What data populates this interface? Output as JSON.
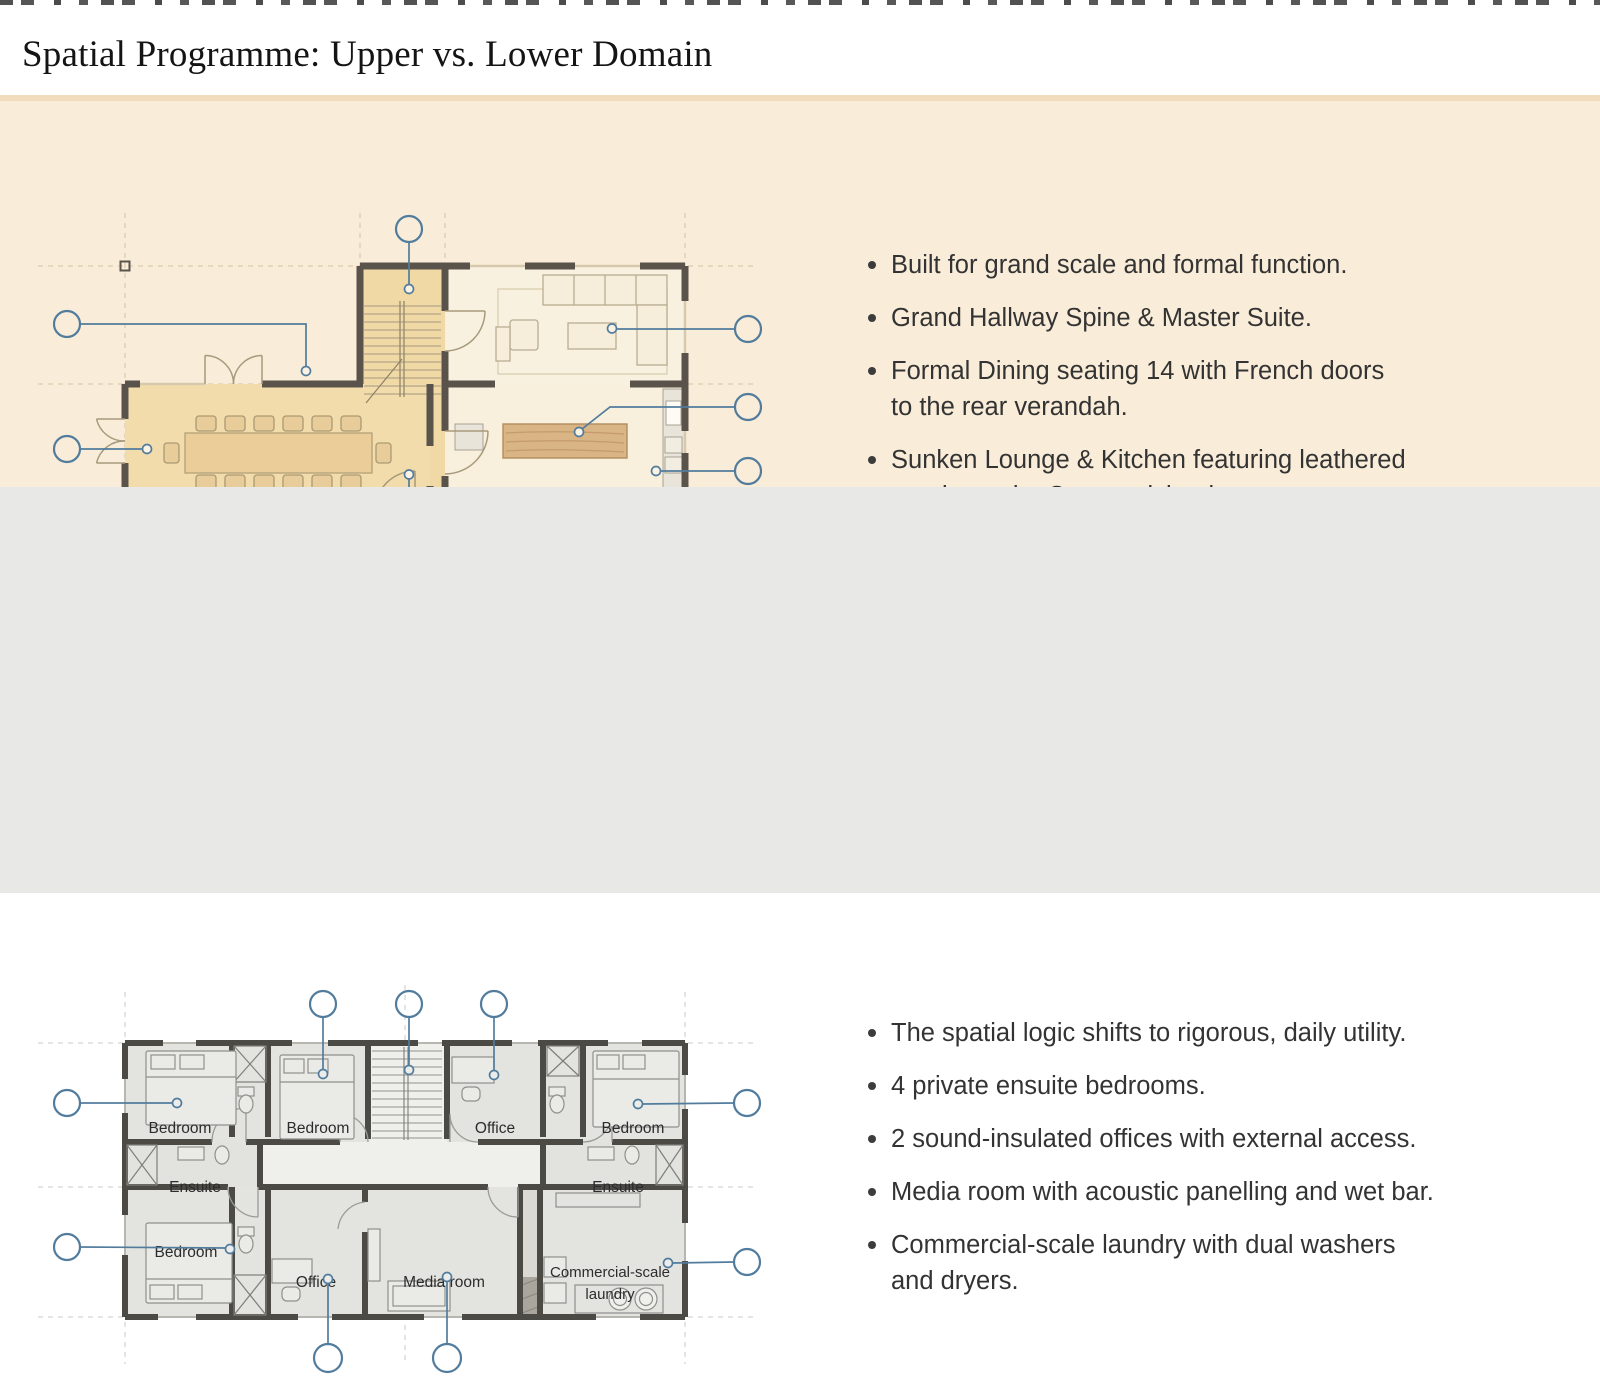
{
  "page": {
    "title": "Spatial Programme: Upper vs. Lower Domain"
  },
  "upper_section": {
    "bullets": [
      "Built for grand scale and formal function.",
      "Grand Hallway Spine & Master Suite.",
      "Formal Dining seating 14 with French doors\nto the rear verandah.",
      "Sunken Lounge & Kitchen featuring leathered\ngranite and a Cypress island."
    ],
    "plan": {
      "dining_seats": 14,
      "callout_counts": {
        "top": 1,
        "bottom": 1,
        "left": 2,
        "right": 3
      }
    }
  },
  "lower_section": {
    "bullets": [
      "The spatial logic shifts to rigorous, daily utility.",
      "4 private ensuite bedrooms.",
      "2 sound-insulated offices with external access.",
      "Media room with acoustic panelling and wet bar.",
      "Commercial-scale laundry with dual washers\nand dryers."
    ],
    "plan": {
      "room_labels": [
        "Bedroom",
        "Bedroom",
        "Office",
        "Bedroom",
        "Ensuite",
        "Ensuite",
        "Bedroom",
        "Office",
        "Media room"
      ],
      "laundry_label": {
        "line1": "Commercial-scale",
        "line2": "laundry"
      },
      "callout_counts": {
        "top": 3,
        "bottom": 2,
        "left": 2,
        "right": 2
      }
    }
  },
  "colors": {
    "header_bg": "#ffffff",
    "upper_band_bg": "#f9edd9",
    "lower_band_bg": "#e8e8e6",
    "room_tan": "#f1d9a6",
    "island_wood": "#d9b485",
    "wall_dark_upper": "#5a534b",
    "wall_dark_lower": "#4b4a45",
    "callout_blue": "#527c9d",
    "text_dark": "#333333"
  }
}
